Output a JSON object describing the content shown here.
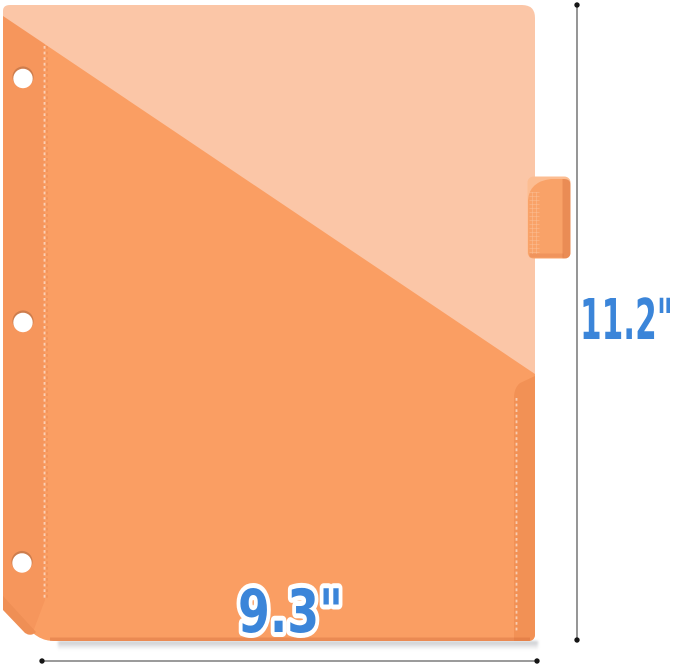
{
  "illustration": {
    "subject": "binder pocket divider with index tab",
    "hole_count": 3,
    "labels": {
      "height": "11.2\"",
      "width": "9.3\""
    }
  },
  "colors": {
    "background": "#ffffff",
    "sheet": "#fbc6a7",
    "pocket": "#fa9e63",
    "pocket_fold": "#f29155",
    "corner_fold": "#ef8f55",
    "tab": "#f9a268",
    "tab_curl": "#fcbd92",
    "hole": "#ffffff",
    "label_blue": "#3b85d9",
    "label_outline": "#ffffff",
    "dimension_line": "#5f5f5f",
    "dimension_dot": "#151515"
  }
}
